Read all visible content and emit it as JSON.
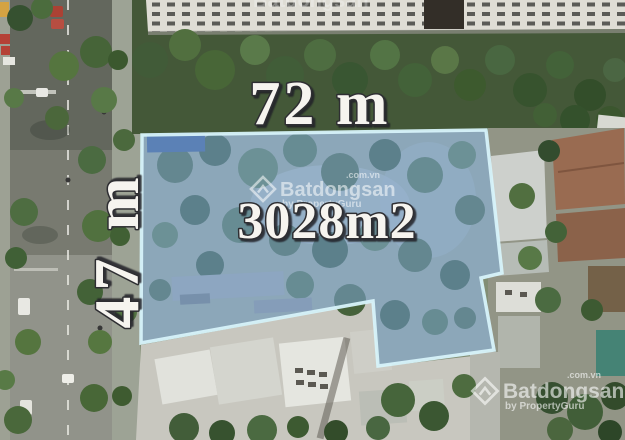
{
  "image": {
    "kind": "aerial-drone-photo",
    "subject": "Land plot for sale with highlighted boundary"
  },
  "labels": {
    "width": "72 m",
    "depth": "47 m",
    "area": "3028m2"
  },
  "plot": {
    "points": "142,135 486,130 502,273 481,278 494,350 378,366 373,301 141,343",
    "fill": "#7BA7DE",
    "border": "#D6F3FA"
  },
  "measure_text": {
    "fill": "#F6F4EF",
    "outline": "#26262A"
  },
  "watermark": {
    "brand": "Batdongsan",
    "tld": ".com.vn",
    "byline": "by PropertyGuru",
    "color": "#FFFFFF"
  }
}
